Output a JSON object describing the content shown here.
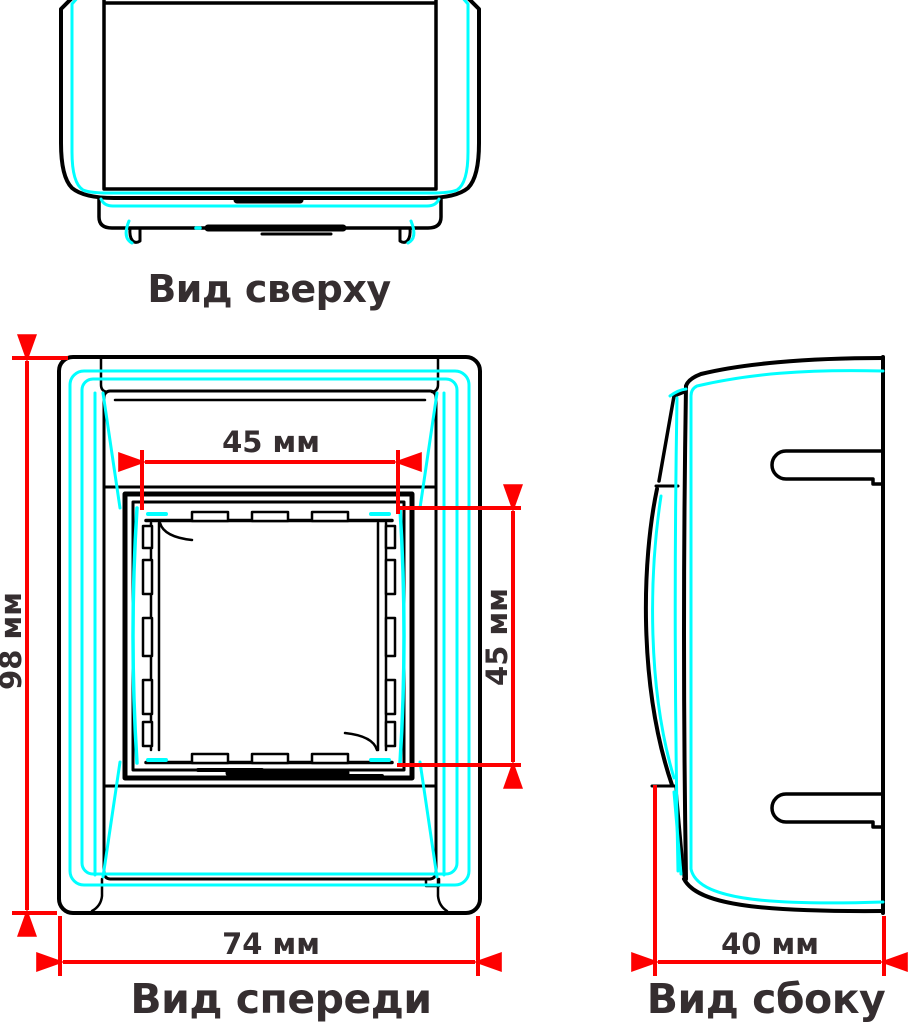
{
  "drawing": {
    "background": "#ffffff",
    "colors": {
      "outline": "#000000",
      "highlight": "#00ffff",
      "dimension": "#fe0000",
      "label": "#352e30"
    },
    "views": {
      "top": {
        "title": "Вид сверху"
      },
      "front": {
        "title": "Вид спереди",
        "dims": {
          "height": "98 мм",
          "width": "74 мм",
          "opening_width": "45 мм",
          "opening_height": "45 мм"
        }
      },
      "side": {
        "title": "Вид сбоку",
        "dims": {
          "depth": "40 мм"
        }
      }
    }
  }
}
